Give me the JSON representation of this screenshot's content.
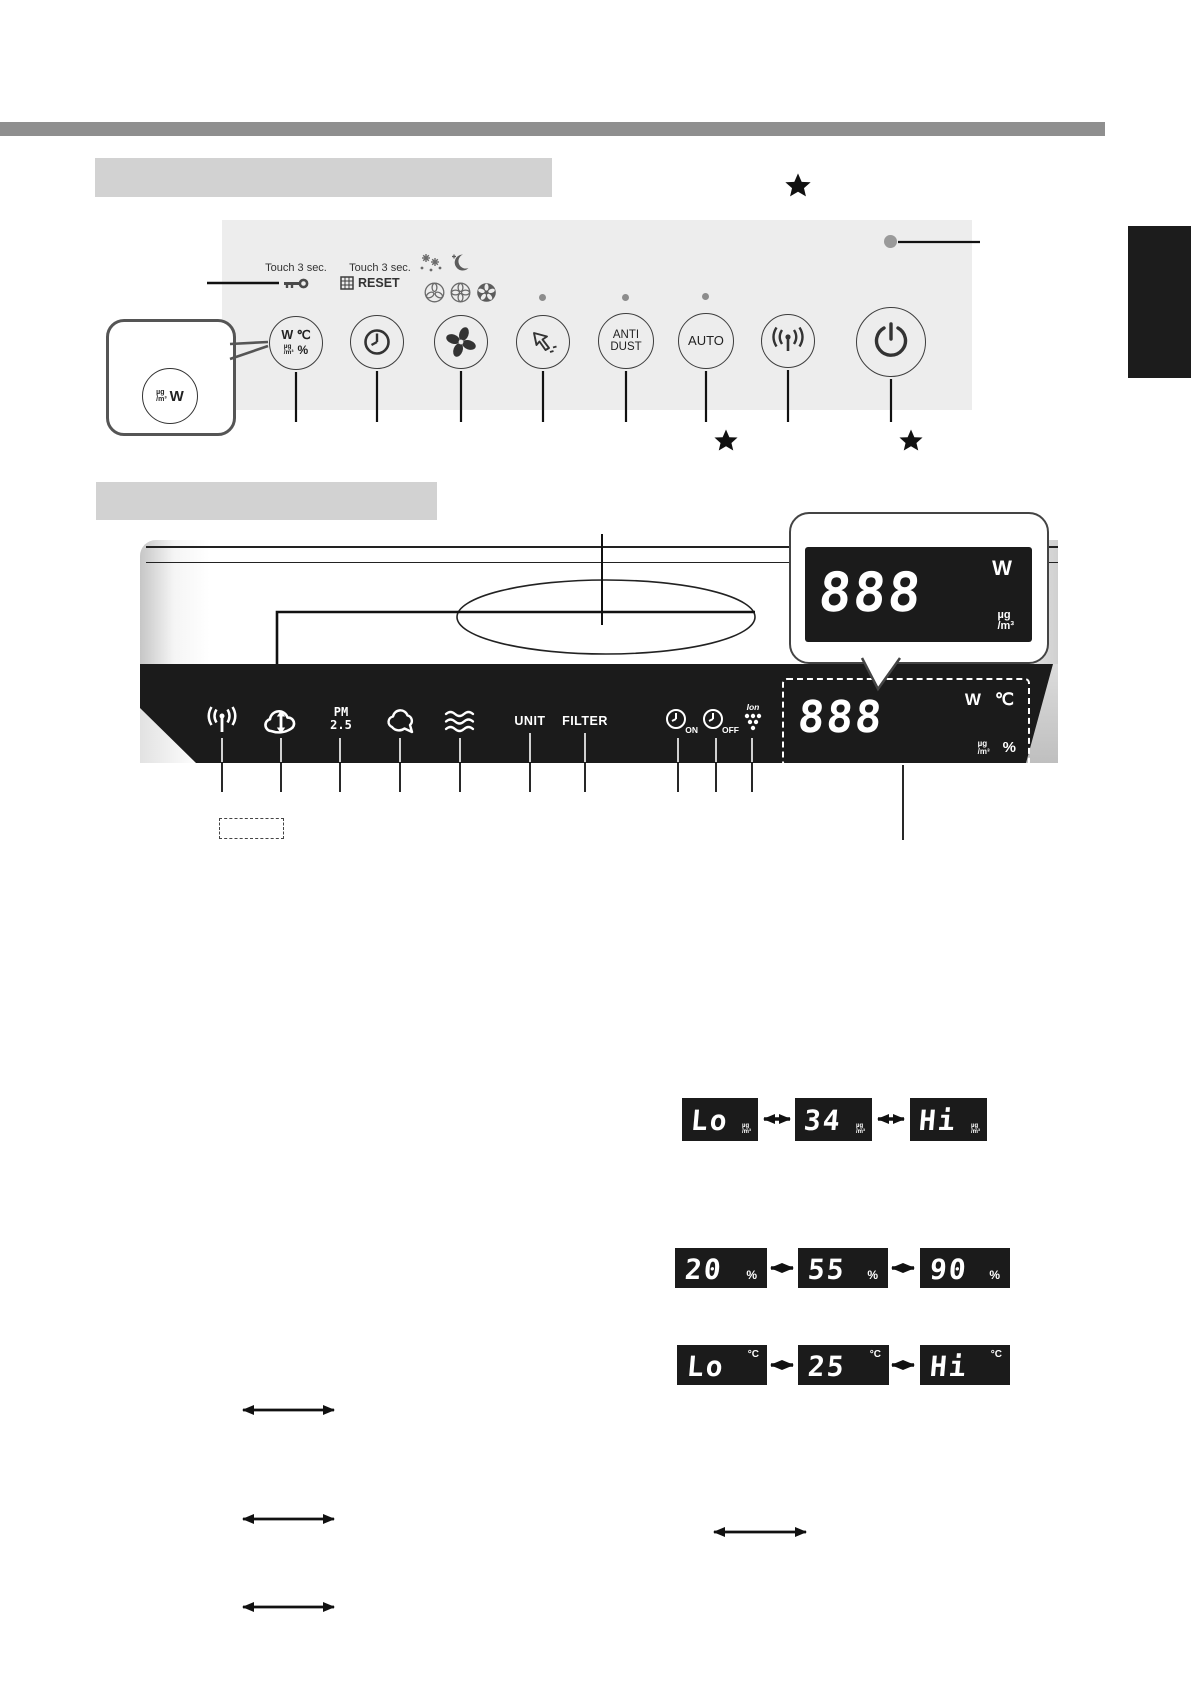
{
  "units": {
    "ug": "µg",
    "m3": "/m³",
    "w": "W",
    "celsius": "℃",
    "percent": "%",
    "deg_c": "°C"
  },
  "control_panel": {
    "touch_left": "Touch 3 sec.",
    "touch_right": "Touch 3 sec.",
    "reset_label": "RESET",
    "buttons": {
      "display_w": "W",
      "display_c": "℃",
      "display_pct": "%",
      "anti_line1": "ANTI",
      "anti_line2": "DUST",
      "auto": "AUTO"
    }
  },
  "callout": {
    "circle_w": "W"
  },
  "display_panel": {
    "unit_label": "UNIT",
    "filter_label": "FILTER",
    "pm_top": "PM",
    "pm_bottom": "2.5",
    "timer_on": "ON",
    "timer_off": "OFF",
    "ion_label": "Ion",
    "main_value": "888",
    "callout_value": "888"
  },
  "led_examples": {
    "row1": [
      "Lo",
      "34",
      "Hi"
    ],
    "row2": [
      "20",
      "55",
      "90"
    ],
    "row3": [
      "Lo",
      "25",
      "Hi"
    ]
  }
}
